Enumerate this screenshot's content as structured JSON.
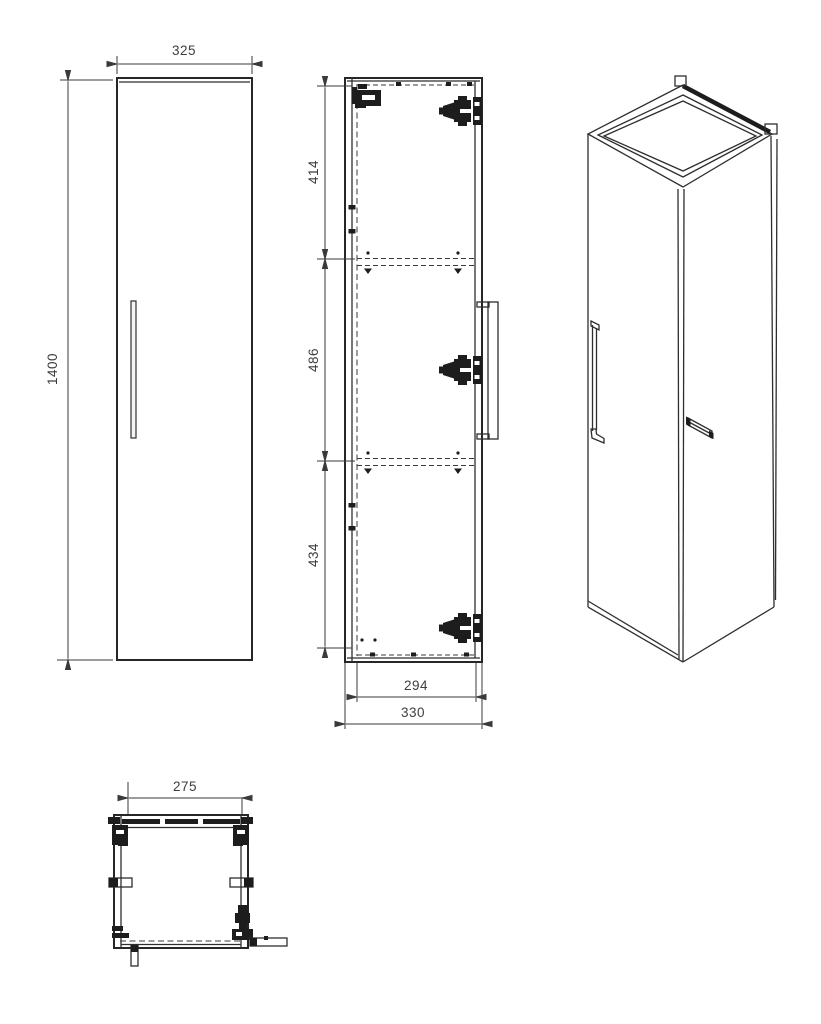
{
  "drawing": {
    "title": "wall-hung-cabinet-technical-drawing",
    "background_color": "#ffffff",
    "line_color": "#2e2e2e",
    "text_color": "#3d3d3d",
    "units": "mm",
    "dimensions": {
      "front_width": "325",
      "front_height": "1400",
      "side_top_section": "414",
      "side_middle_section": "486",
      "side_bottom_section": "434",
      "side_inner_depth": "294",
      "side_outer_depth": "330",
      "plan_inner_width": "275"
    },
    "views": {
      "front_view": "front elevation with vertical door handle",
      "side_section_view": "side section with 3 hinges, wall bracket, 2 shelves, handle",
      "perspective_view": "isometric view, open top, wall hanger tabs, handles",
      "plan_view": "bottom plan with wall brackets, side clips and hinge"
    }
  }
}
